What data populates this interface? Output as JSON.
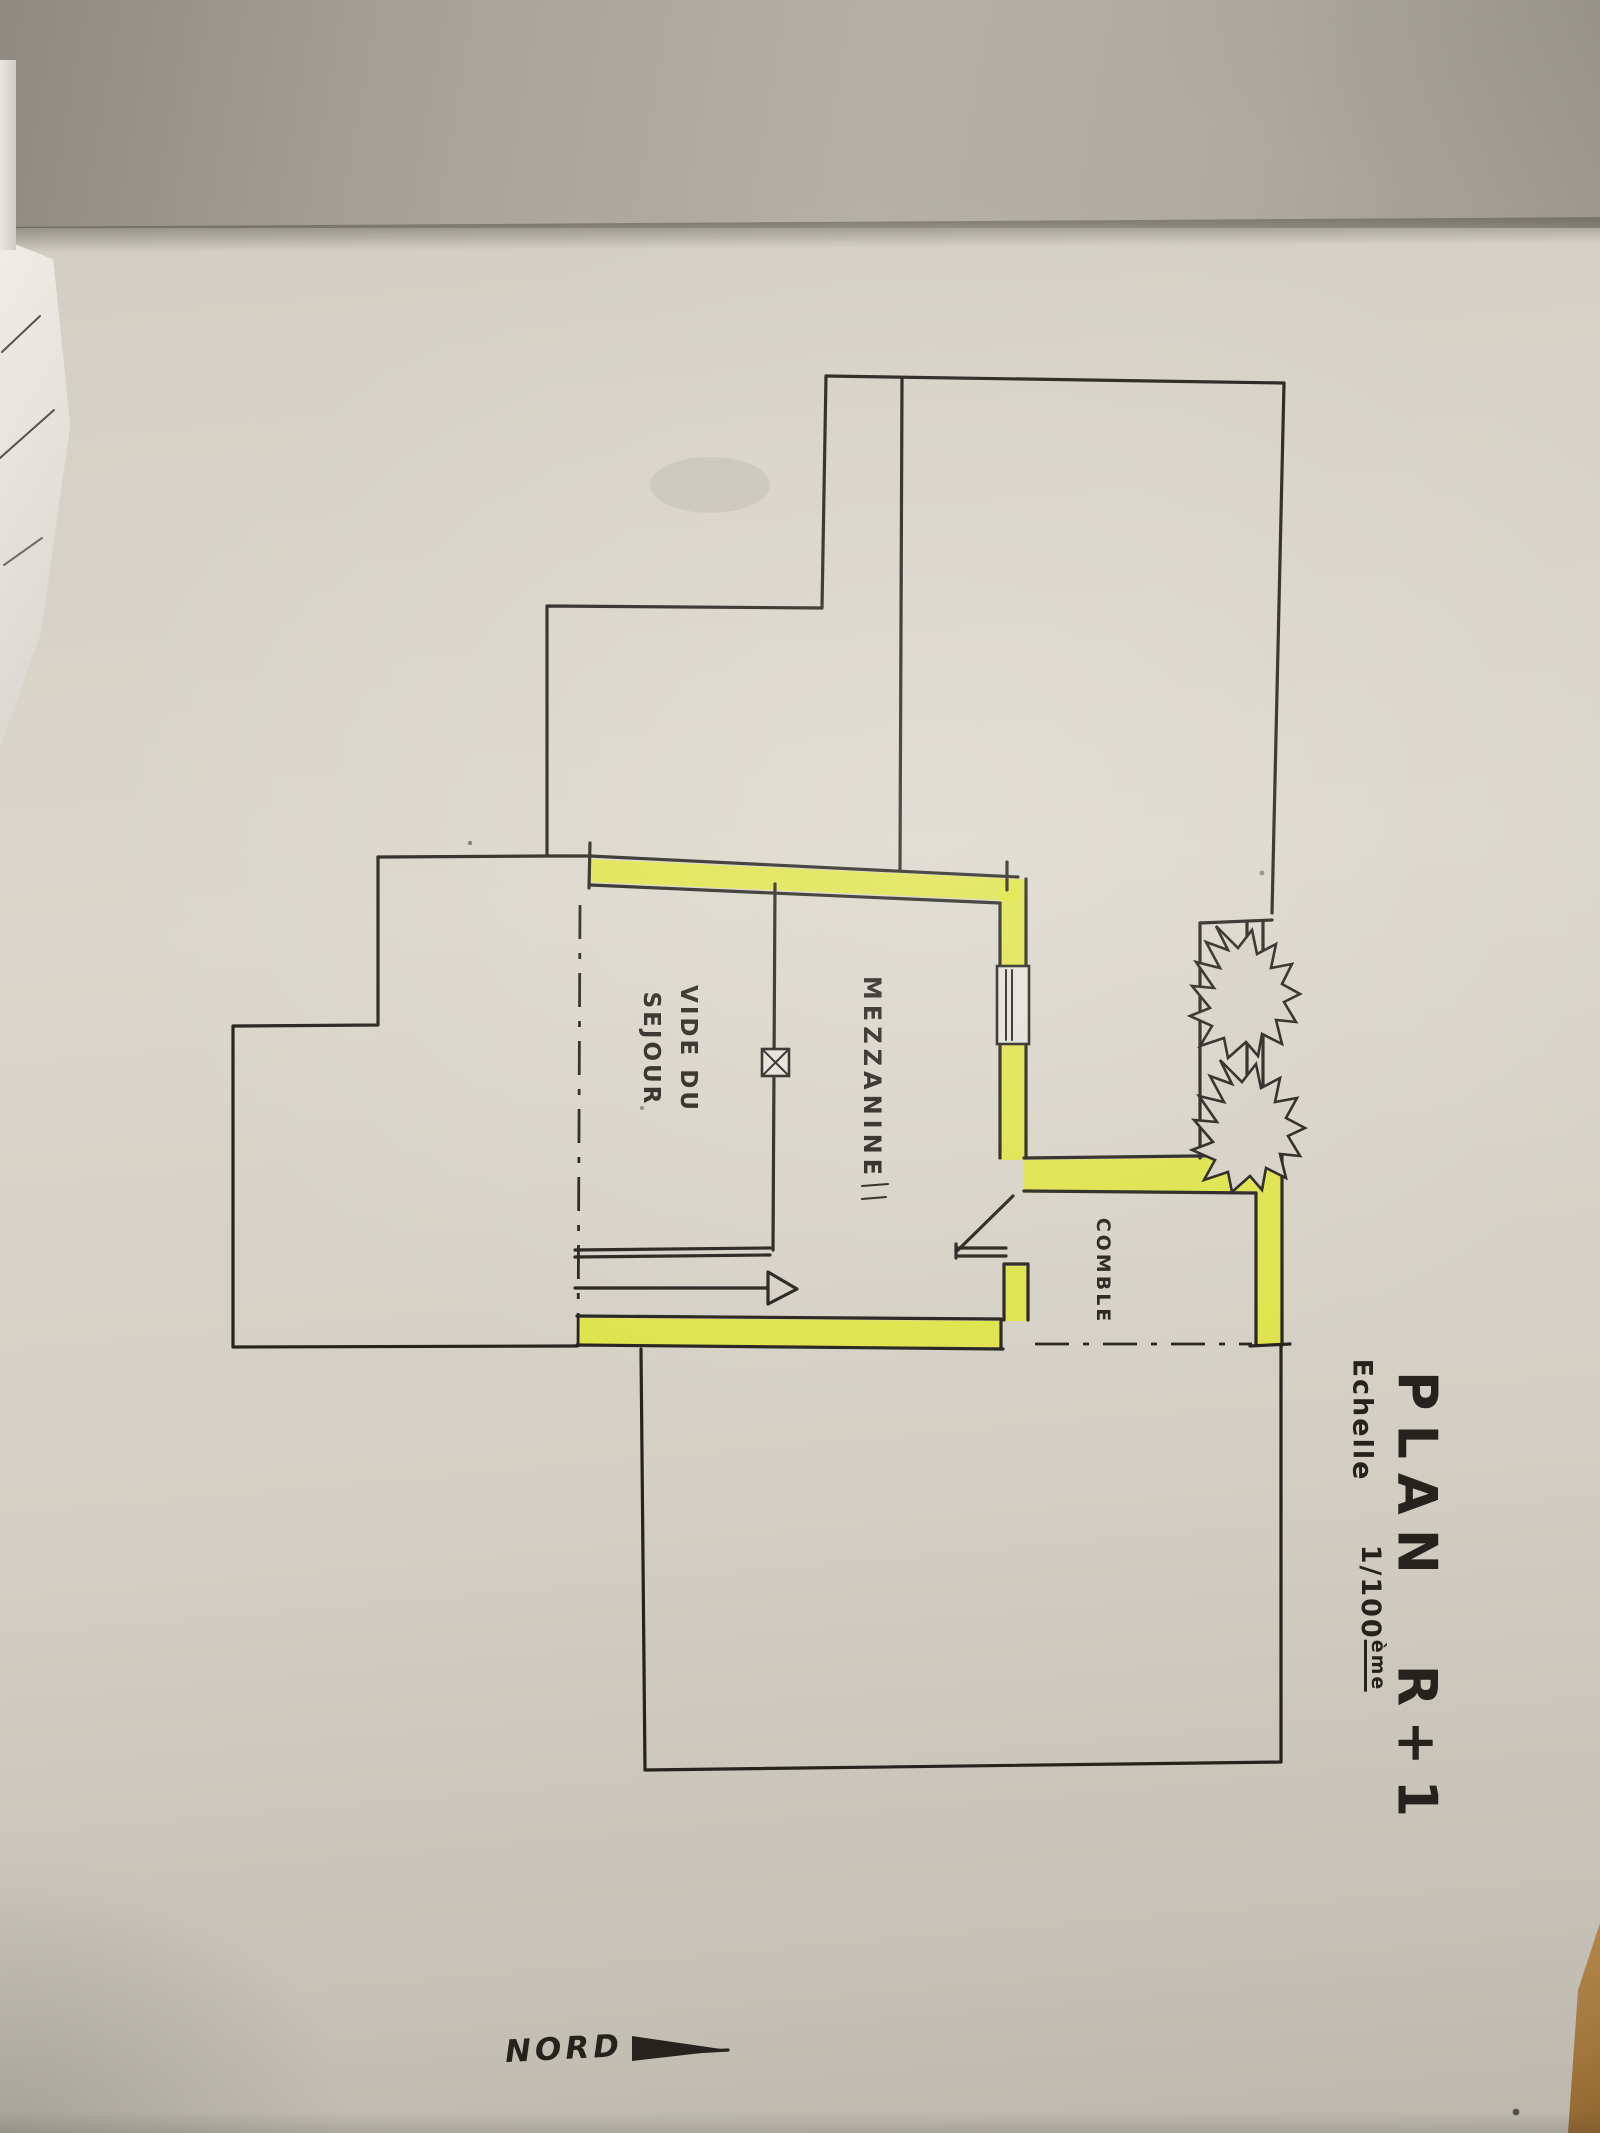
{
  "title": "PLAN R+1",
  "scale": {
    "label": "Echelle",
    "value": "1/100",
    "suffix": "ème"
  },
  "rooms": {
    "mezzanine": "MEZZANINE",
    "vide_line1": "VIDE DU",
    "vide_line2": "SEJOUR",
    "comble": "COMBLE"
  },
  "compass": {
    "label": "NORD",
    "icon": "north-arrow-icon"
  },
  "colors": {
    "highlight": "#dfe53a",
    "ink": "#26231e",
    "paper": "#d6d2c7",
    "top_sheet": "#a9a59c",
    "table_wood": "#a87c44"
  },
  "symbols": {
    "break_marks": "wall-break-starburst-icon",
    "column_marker": "column-x-marker-icon",
    "door": "door-swing-icon",
    "window": "window-icon",
    "void_boundary": "dash-dot-line",
    "direction_arrow": "stair-direction-arrow-icon",
    "north_arrow": "north-arrow-icon"
  }
}
